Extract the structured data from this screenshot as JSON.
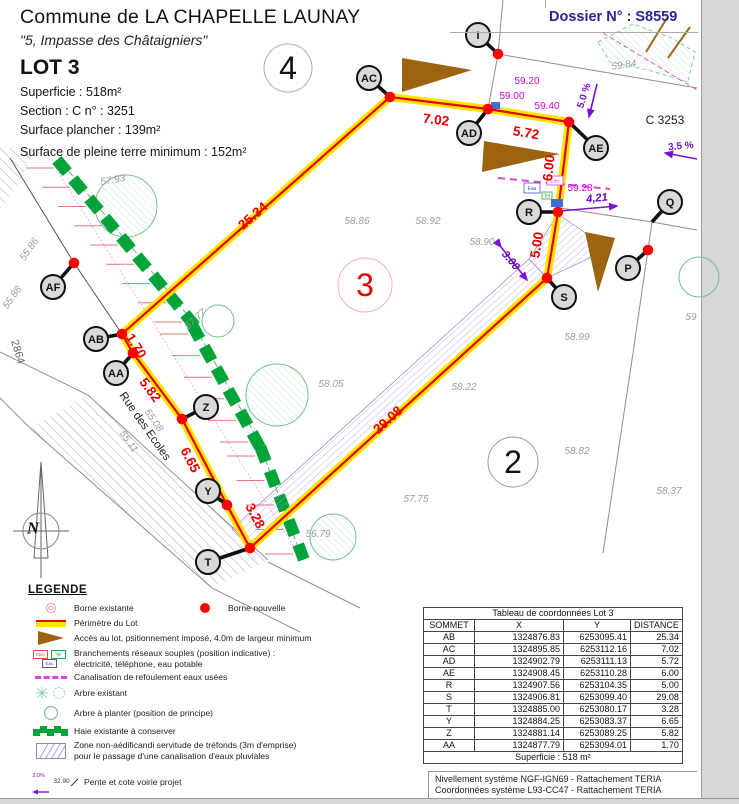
{
  "header": {
    "commune": "Commune de LA CHAPELLE LAUNAY",
    "address": "\"5, Impasse des Châtaigniers\"",
    "lot": "LOT 3",
    "superficie": "Superficie :    518m²",
    "section": "Section :   C     n° :   3251",
    "surface_plancher": "Surface plancher : 139m²",
    "surface_pleine_terre": "Surface de pleine terre minimum : 152m²",
    "dossier": "Dossier N° : S8559"
  },
  "plan": {
    "labels": [
      [
        "25.34",
        253,
        216,
        -41,
        "meas"
      ],
      [
        "7.02",
        436,
        120,
        7,
        "meas"
      ],
      [
        "5.72",
        526,
        133,
        9,
        "meas"
      ],
      [
        "6.00",
        549,
        168,
        -84,
        "meas"
      ],
      [
        "5.00",
        537,
        245,
        -81,
        "meas"
      ],
      [
        "29.08",
        388,
        420,
        -42,
        "meas"
      ],
      [
        "3.28",
        255,
        516,
        62,
        "meas"
      ],
      [
        "6.65",
        190,
        460,
        62,
        "meas"
      ],
      [
        "5.82",
        150,
        390,
        53,
        "meas"
      ],
      [
        "1.70",
        136,
        346,
        58,
        "meas"
      ],
      [
        "57.93",
        113,
        181,
        -10,
        "elev"
      ],
      [
        "55.86",
        30,
        250,
        -55,
        "elev"
      ],
      [
        "55.88",
        13,
        298,
        -55,
        "elev"
      ],
      [
        "57.77",
        196,
        320,
        -42,
        "elev"
      ],
      [
        "58.86",
        357,
        222,
        0,
        "elev"
      ],
      [
        "58.92",
        428,
        222,
        0,
        "elev"
      ],
      [
        "58.90",
        482,
        243,
        0,
        "elev"
      ],
      [
        "58.05",
        331,
        385,
        0,
        "elev"
      ],
      [
        "58.22",
        464,
        388,
        0,
        "elev"
      ],
      [
        "57.75",
        416,
        500,
        0,
        "elev"
      ],
      [
        "56.79",
        318,
        535,
        0,
        "elev"
      ],
      [
        "58.82",
        577,
        452,
        0,
        "elev"
      ],
      [
        "58.37",
        669,
        492,
        0,
        "elev"
      ],
      [
        "58.99",
        577,
        338,
        0,
        "elev"
      ],
      [
        "59.84",
        624,
        66,
        -8,
        "elev"
      ],
      [
        "55.08",
        153,
        421,
        55,
        "elev"
      ],
      [
        "55.11",
        128,
        442,
        55,
        "elev"
      ],
      [
        "59",
        691,
        318,
        0,
        "elev"
      ],
      [
        "59.20",
        527,
        82,
        0,
        "mag"
      ],
      [
        "59.00",
        512,
        97,
        0,
        "mag"
      ],
      [
        "59.40",
        547,
        107,
        0,
        "mag"
      ],
      [
        "59.28",
        580,
        189,
        0,
        "mag"
      ],
      [
        "5.0 %",
        585,
        96,
        -72,
        "pur"
      ],
      [
        "3.5 %",
        681,
        147,
        -5,
        "pur"
      ],
      [
        "4,21",
        597,
        199,
        -6,
        "puri"
      ],
      [
        "3.00",
        510,
        261,
        50,
        "puri"
      ],
      [
        "C 3253",
        665,
        120,
        0,
        "blk"
      ],
      [
        "4",
        288,
        68,
        0,
        "pnum"
      ],
      [
        "3",
        365,
        285,
        0,
        "pnumr"
      ],
      [
        "2",
        513,
        462,
        0,
        "pnum"
      ],
      [
        "Rue des Ecoles",
        144,
        427,
        55,
        "street"
      ],
      [
        "2864",
        17,
        352,
        73,
        "gray"
      ],
      [
        "N",
        33,
        528,
        0,
        "north"
      ]
    ],
    "vertices": [
      [
        "AB",
        96,
        339,
        122,
        334,
        1
      ],
      [
        "AA",
        116,
        373,
        133,
        353,
        1
      ],
      [
        "Z",
        206,
        407,
        182,
        419,
        1
      ],
      [
        "Y",
        208,
        491,
        227,
        505,
        1
      ],
      [
        "T",
        208,
        562,
        250,
        548,
        1
      ],
      [
        "AF",
        53,
        287,
        74,
        263,
        1
      ],
      [
        "AC",
        369,
        78,
        390,
        97,
        1
      ],
      [
        "AD",
        469,
        133,
        488,
        109,
        1
      ],
      [
        "AE",
        596,
        148,
        569,
        122,
        1
      ],
      [
        "R",
        529,
        212,
        558,
        212,
        1
      ],
      [
        "S",
        564,
        297,
        547,
        278,
        1
      ],
      [
        "Q",
        670,
        202,
        652,
        222,
        0
      ],
      [
        "P",
        628,
        268,
        648,
        250,
        1
      ],
      [
        "I",
        478,
        35,
        498,
        54,
        1
      ]
    ],
    "utility_boxes": [
      [
        "Eau",
        524,
        183,
        16,
        10,
        "#4a4ad8"
      ],
      [
        "Elec",
        547,
        176,
        16,
        9,
        "#e040e0"
      ],
      [
        "Tel",
        542,
        192,
        10,
        7,
        "#2aa84a"
      ]
    ]
  },
  "legend": {
    "title": "LEGENDE",
    "items": [
      {
        "icon": "borne-existante",
        "text": "Borne existante"
      },
      {
        "icon": "borne-nouvelle",
        "text": "Borne nouvelle"
      },
      {
        "icon": "perimetre",
        "text": "Périmètre du Lot"
      },
      {
        "icon": "acces",
        "text": "Accès au lot, psitionnement imposé, 4.0m de largeur minimum"
      },
      {
        "icon": "branchements",
        "text": "Branchements réseaux souples (position indicative) :",
        "text2": " électricité, téléphone, eau potable",
        "boxes": [
          "Elec",
          "Tel",
          "Eau"
        ]
      },
      {
        "icon": "canalisation",
        "text": "Canalisation de refoulement eaux usées"
      },
      {
        "icon": "arbre-existant",
        "text": "Arbre existant"
      },
      {
        "icon": "arbre-a-planter",
        "text": "Arbre à planter (position de principe)"
      },
      {
        "icon": "haie",
        "text": "Haie existante à conserver"
      },
      {
        "icon": "zone",
        "text": "Zone non-aédificandi servitude de tréfonds (3m d'emprise)",
        "text2": "pour le passage d'une canalisation d'eaux pluviales"
      },
      {
        "icon": "pente",
        "text": "Pente et cote voirie projet",
        "icon_labels": [
          "2.0%",
          "32.90"
        ]
      },
      {
        "icon": "cote",
        "text": "Cote altimétrique du terrain naturel",
        "icon_label": "21.56"
      },
      {
        "icon": "matricule",
        "text": "Matricule du sommet du périmètre du lot",
        "icon_label": "J"
      }
    ]
  },
  "table": {
    "title": "Tableau de coordonnées Lot 3",
    "headers": [
      "SOMMET",
      "X",
      "Y",
      "DISTANCE"
    ],
    "rows": [
      [
        "AB",
        "1324876.83",
        "6253095.41",
        "25.34"
      ],
      [
        "AC",
        "1324895.85",
        "6253112.16",
        "7.02"
      ],
      [
        "AD",
        "1324902.79",
        "6253111.13",
        "5.72"
      ],
      [
        "AE",
        "1324908.45",
        "6253110.28",
        "6.00"
      ],
      [
        "R",
        "1324907.56",
        "6253104.35",
        "5.00"
      ],
      [
        "S",
        "1324906.81",
        "6253099.40",
        "29.08"
      ],
      [
        "T",
        "1324885.00",
        "6253080.17",
        "3.28"
      ],
      [
        "Y",
        "1324884.25",
        "6253083.37",
        "6.65"
      ],
      [
        "Z",
        "1324881.14",
        "6253089.25",
        "5.82"
      ],
      [
        "AA",
        "1324877.79",
        "6253094.01",
        "1.70"
      ]
    ],
    "footer": "Superficie : 518 m²"
  },
  "footer": {
    "line1": "Nivellement système NGF-IGN69 - Rattachement TERIA",
    "line2": "Coordonnées système L93-CC47  - Rattachement TERIA"
  }
}
